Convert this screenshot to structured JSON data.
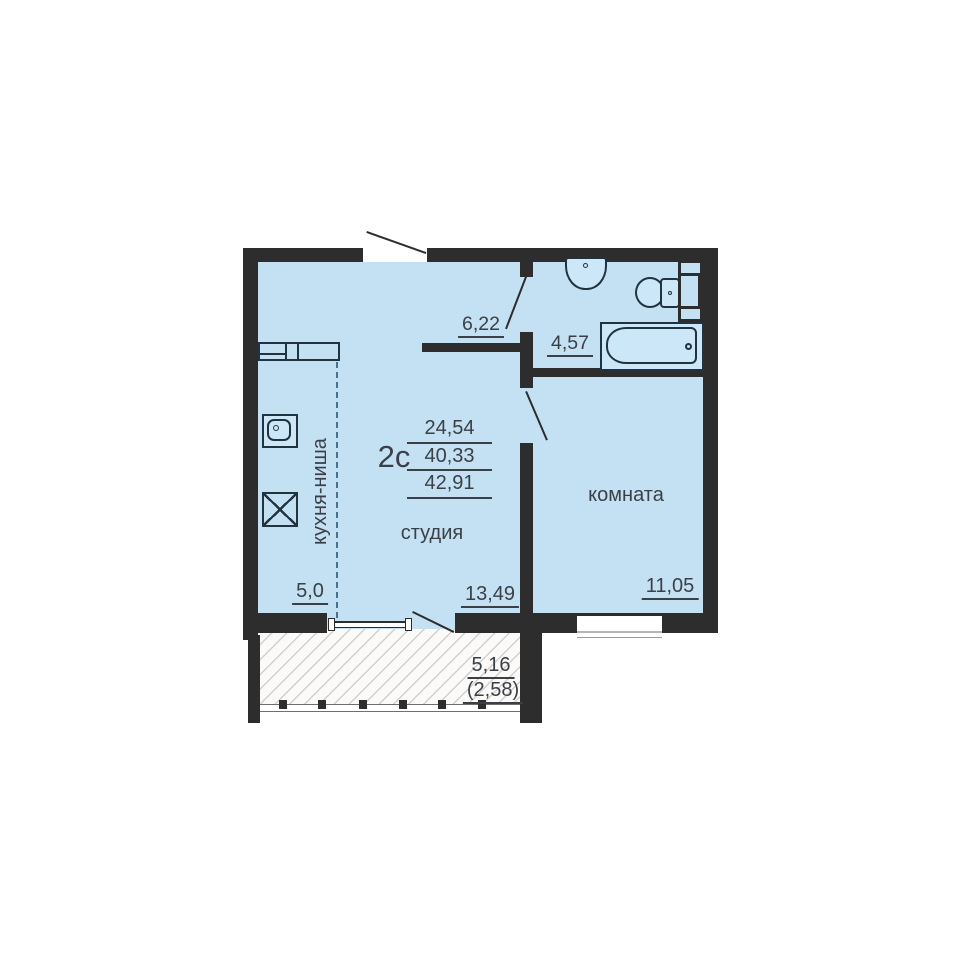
{
  "plan_title": "floor-plan-2s",
  "unit": {
    "type_label": "2с",
    "area_lines": [
      "24,54",
      "40,33",
      "42,91"
    ]
  },
  "rooms": {
    "hallway_area": "6,22",
    "bathroom_area": "4,57",
    "kitchen_name": "кухня-ниша",
    "kitchen_area": "5,0",
    "studio_name": "студия",
    "studio_area": "13,49",
    "room_name": "комната",
    "room_area": "11,05",
    "balcony_area": "5,16",
    "balcony_area_reduced": "(2,58)"
  },
  "icons": {
    "washbasin": "rounded-bowl-with-faucet-dot",
    "toilet": "oval-bowl-with-tank",
    "bathtub": "rounded-inner-tub-with-drain-dot",
    "vent_shaft": "dark-strip-with-three-openings",
    "kitchen_sink": "square-with-rounded-basin-and-faucet-dot",
    "stove": "square-with-x-cross",
    "kitchen_counter": "divided-counter-rectangle",
    "door_swing": "diagonal-leaf-line",
    "balcony_glazing": "thin-double-line-with-end-caps",
    "balcony_railing": "thin-line-with-square-posts"
  },
  "colors": {
    "floor_fill": "#c4e1f4",
    "wall": "#2d2d2d",
    "fixture_outline": "#20333e",
    "fixture_fill": "#cbe7f8",
    "text": "#3a4046",
    "dashed_partition": "#46718f",
    "hatch_background": "#fbfaf8",
    "background": "#ffffff"
  }
}
